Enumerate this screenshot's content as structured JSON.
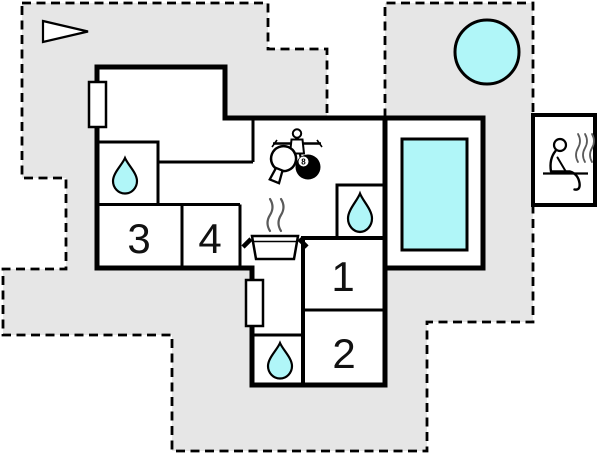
{
  "colors": {
    "plot": "#e6e6e6",
    "water": "#b0f6f8",
    "wall": "#000000",
    "interior": "#ffffff"
  },
  "rooms": {
    "r1": {
      "label": "1"
    },
    "r2": {
      "label": "2"
    },
    "r3": {
      "label": "3"
    },
    "r4": {
      "label": "4"
    }
  },
  "games": {
    "ball_label": "8"
  },
  "icons": {
    "north_arrow": "triangle-pointer",
    "hot_tub": "round-water-tub",
    "pool": "rectangular-water-pool",
    "bathroom_1": "water-drop",
    "bathroom_2": "water-drop",
    "bathroom_3": "water-drop",
    "kitchen": "cooking-pot-with-steam",
    "games_area": "foosball-player-table-tennis-paddle-8ball",
    "sauna": "sitting-person-with-steam",
    "window": "wall-opening",
    "door": "wall-opening"
  }
}
